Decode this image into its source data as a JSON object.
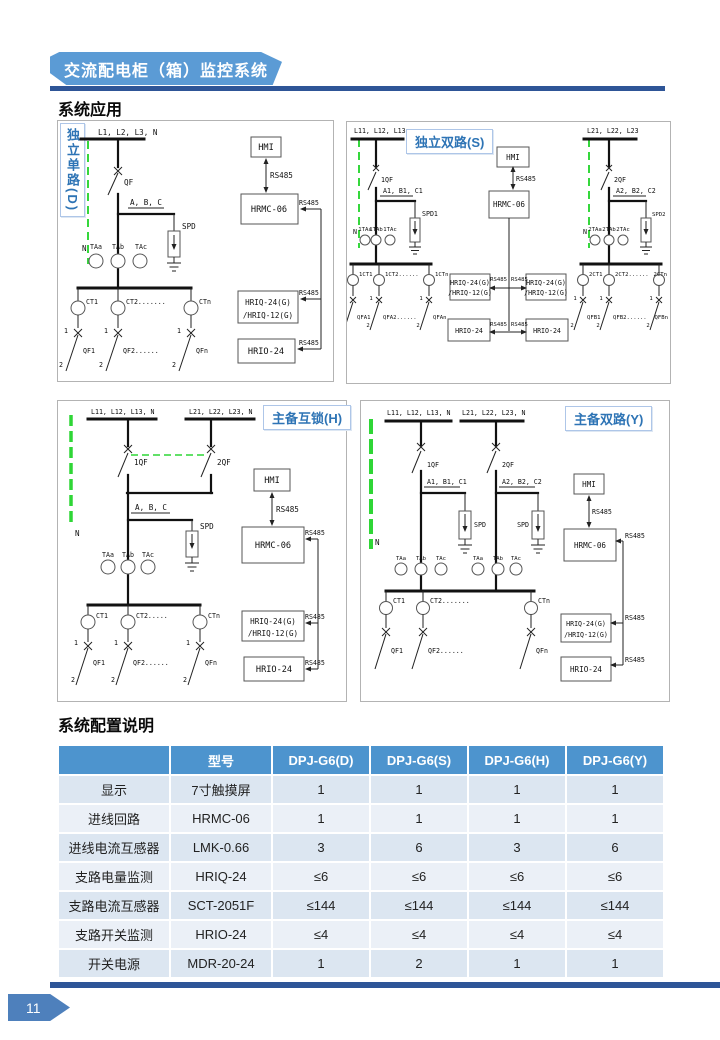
{
  "page": {
    "banner_title": "交流配电柜（箱）监控系统",
    "applications_title": "系统应用",
    "config_title": "系统配置说明",
    "page_number": "11"
  },
  "common": {
    "hmi": "HMI",
    "rs485": "RS485",
    "hrmc": "HRMC-06",
    "hriq_line1": "HRIQ-24(G)",
    "hriq_line2": "/HRIQ-12(G)",
    "hrio": "HRIO-24",
    "spd": "SPD",
    "n": "N",
    "one": "1",
    "two": "2"
  },
  "diagram_d": {
    "title": "独立单路(D)",
    "bus": "L1, L2, L3, N",
    "breaker": "QF",
    "phases": "A, B, C",
    "ta": [
      "TAa",
      "TAb",
      "TAc"
    ],
    "ct": [
      "CT1",
      "CT2.......",
      "CTn"
    ],
    "feeders": [
      "QF1",
      "QF2......",
      "QFn"
    ]
  },
  "diagram_s": {
    "title": "独立双路(S)",
    "bus_left": "L11, L12, L13",
    "bus_right": "L21, L22, L23",
    "breaker_left": "1QF",
    "breaker_right": "2QF",
    "phases_left": "A1, B1, C1",
    "phases_right": "A2, B2, C2",
    "spd_left": "SPD1",
    "spd_right": "SPD2",
    "ta_left": [
      "1TAa",
      "1TAb",
      "1TAc"
    ],
    "ta_right": [
      "2TAa",
      "2TAb",
      "2TAc"
    ],
    "ct_left": [
      "1CT1",
      "1CT2......",
      "1CTn"
    ],
    "ct_right": [
      "2CT1",
      "2CT2......",
      "2CTn"
    ],
    "feeders_left": [
      "QFA1",
      "QFA2......",
      "QFAn"
    ],
    "feeders_right": [
      "QFB1",
      "QFB2......",
      "QFBn"
    ]
  },
  "diagram_h": {
    "title": "主备互锁(H)",
    "bus_left": "L11, L12, L13, N",
    "bus_right": "L21, L22, L23, N",
    "breaker_left": "1QF",
    "breaker_right": "2QF",
    "phases": "A, B, C",
    "ta": [
      "TAa",
      "TAb",
      "TAc"
    ],
    "ct": [
      "CT1",
      "CT2.....",
      "CTn"
    ],
    "feeders": [
      "QF1",
      "QF2......",
      "QFn"
    ]
  },
  "diagram_y": {
    "title": "主备双路(Y)",
    "bus_left": "L11, L12, L13, N",
    "bus_right": "L21, L22, L23, N",
    "breaker_left": "1QF",
    "breaker_right": "2QF",
    "phases_left": "A1, B1, C1",
    "phases_right": "A2, B2, C2",
    "ta": [
      "TAa",
      "TAb",
      "TAc"
    ],
    "ct": [
      "CT1",
      "CT2.......",
      "CTn"
    ],
    "feeders": [
      "QF1",
      "QF2......",
      "QFn"
    ]
  },
  "config_table": {
    "headers": [
      "",
      "型号",
      "DPJ-G6(D)",
      "DPJ-G6(S)",
      "DPJ-G6(H)",
      "DPJ-G6(Y)"
    ],
    "rows": [
      [
        "显示",
        "7寸触摸屏",
        "1",
        "1",
        "1",
        "1"
      ],
      [
        "进线回路",
        "HRMC-06",
        "1",
        "1",
        "1",
        "1"
      ],
      [
        "进线电流互感器",
        "LMK-0.66",
        "3",
        "6",
        "3",
        "6"
      ],
      [
        "支路电量监测",
        "HRIQ-24",
        "≤6",
        "≤6",
        "≤6",
        "≤6"
      ],
      [
        "支路电流互感器",
        "SCT-2051F",
        "≤144",
        "≤144",
        "≤144",
        "≤144"
      ],
      [
        "支路开关监测",
        "HRIO-24",
        "≤4",
        "≤4",
        "≤4",
        "≤4"
      ],
      [
        "开关电源",
        "MDR-20-24",
        "1",
        "2",
        "1",
        "1"
      ]
    ]
  },
  "colors": {
    "accent_blue": "#5b9bd5",
    "dark_blue": "#2e5597",
    "table_header": "#4d94ce",
    "row_dark": "#dce6f1",
    "row_light": "#ebf0f7",
    "label_blue": "#2e74b5",
    "wire_green": "#2fd636"
  }
}
